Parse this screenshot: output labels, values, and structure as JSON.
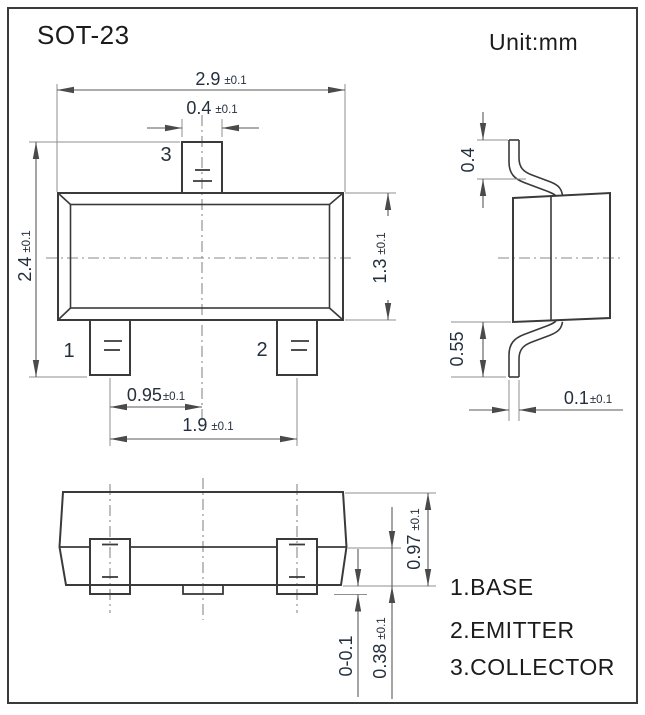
{
  "title": "SOT-23",
  "unit_label": "Unit:mm",
  "colors": {
    "background": "#ffffff",
    "object_line": "#3a3a3a",
    "dimension_line": "#5a5a5a",
    "extension_line": "#8f8f8f",
    "dimension_text": "#24303e",
    "heading_text": "#1b1b1b"
  },
  "front_view": {
    "pin_labels": {
      "pin1": "1",
      "pin2": "2",
      "pin3": "3"
    },
    "dimensions": {
      "body_width": {
        "value": "2.9",
        "tolerance": "±0.1"
      },
      "tab_width": {
        "value": "0.4",
        "tolerance": "±0.1"
      },
      "overall_height": {
        "value": "2.4",
        "tolerance": "±0.1"
      },
      "body_height": {
        "value": "1.3",
        "tolerance": "±0.1"
      },
      "lead_pitch": {
        "value": "0.95",
        "tolerance": "±0.1"
      },
      "lead_span": {
        "value": "1.9",
        "tolerance": "±0.1"
      }
    }
  },
  "side_view": {
    "dimensions": {
      "upper_lead_length": {
        "value": "0.4"
      },
      "lower_lead_length": {
        "value": "0.55"
      },
      "lead_thickness": {
        "value": "0.1",
        "tolerance": "±0.1"
      }
    }
  },
  "bottom_view": {
    "dimensions": {
      "body_side_height": {
        "value": "0.97",
        "tolerance": "±0.1"
      },
      "lead_foot_height": {
        "value": "0.38",
        "tolerance": "±0.1"
      },
      "standoff": {
        "value": "0-0.1"
      }
    }
  },
  "legend": {
    "items": [
      "1.BASE",
      "2.EMITTER",
      "3.COLLECTOR"
    ]
  }
}
